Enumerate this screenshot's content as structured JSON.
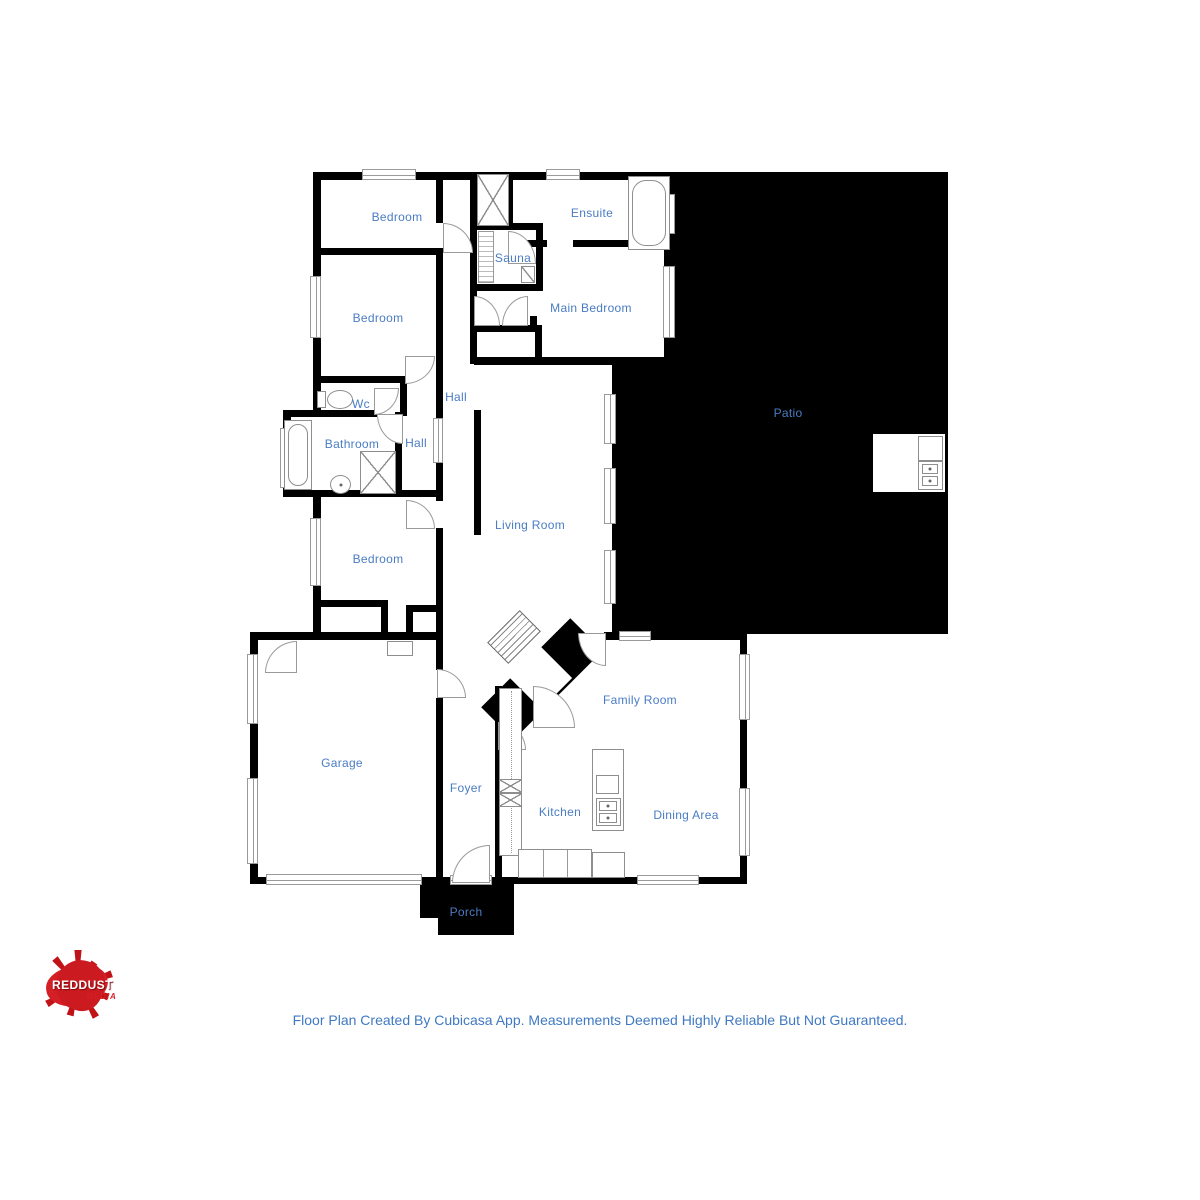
{
  "rooms": [
    {
      "id": "bedroom-top",
      "label": "Bedroom"
    },
    {
      "id": "ensuite",
      "label": "Ensuite"
    },
    {
      "id": "sauna",
      "label": "Sauna"
    },
    {
      "id": "main-bedroom",
      "label": "Main Bedroom"
    },
    {
      "id": "bedroom-middle",
      "label": "Bedroom"
    },
    {
      "id": "wc",
      "label": "Wc"
    },
    {
      "id": "hall-upper",
      "label": "Hall"
    },
    {
      "id": "bathroom",
      "label": "Bathroom"
    },
    {
      "id": "hall-lower",
      "label": "Hall"
    },
    {
      "id": "living-room",
      "label": "Living Room"
    },
    {
      "id": "patio",
      "label": "Patio"
    },
    {
      "id": "bedroom-lower",
      "label": "Bedroom"
    },
    {
      "id": "garage",
      "label": "Garage"
    },
    {
      "id": "foyer",
      "label": "Foyer"
    },
    {
      "id": "kitchen",
      "label": "Kitchen"
    },
    {
      "id": "family-room",
      "label": "Family Room"
    },
    {
      "id": "dining-area",
      "label": "Dining Area"
    },
    {
      "id": "porch",
      "label": "Porch"
    }
  ],
  "footer": {
    "text": "Floor Plan Created By Cubicasa App. Measurements Deemed Highly Reliable But Not Guaranteed."
  },
  "logo": {
    "name1": "RED",
    "name2": "DUST",
    "tagline": "MEDIA"
  },
  "colors": {
    "label_blue": "#4a7cc3",
    "wall_black": "#000000",
    "logo_red": "#d41f26",
    "fixture_gray": "#8e8e8e"
  }
}
